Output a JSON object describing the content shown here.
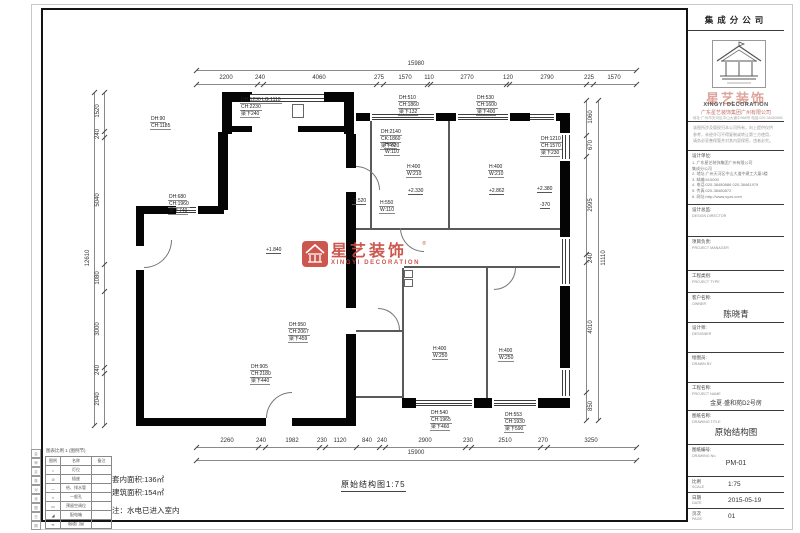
{
  "sheet": {
    "title_note": "原始结构图1:75",
    "notes": [
      "套内面积:136㎡",
      "建筑面积:154㎡",
      "注：水电已进入室内"
    ]
  },
  "watermark": {
    "cn": "星艺装饰",
    "en": "XINGYI DECORATION",
    "reg": "®"
  },
  "legend": {
    "title": "图表比例 1 (图例节)",
    "headers": [
      "图例",
      "名称",
      "备注"
    ],
    "rows": [
      [
        "•",
        "灯位",
        ""
      ],
      [
        "⊙",
        "插座",
        ""
      ],
      [
        "—",
        "给、排水管",
        ""
      ],
      [
        "≈",
        "一般孔",
        ""
      ],
      [
        "▭",
        "预留空调位",
        ""
      ],
      [
        "◢",
        "配电箱",
        ""
      ],
      [
        "▪▪",
        "烟道门窗",
        ""
      ]
    ]
  },
  "side_strip": [
    "会",
    "审",
    "定",
    "核",
    "对",
    "设",
    "图",
    "日",
    "期"
  ],
  "dims": {
    "top_total": {
      "t": "15980",
      "x": 416,
      "y": 64
    },
    "top": [
      {
        "t": "2200",
        "x": 226
      },
      {
        "t": "240",
        "x": 260
      },
      {
        "t": "4060",
        "x": 319
      },
      {
        "t": "275",
        "x": 379
      },
      {
        "t": "1570",
        "x": 405
      },
      {
        "t": "110",
        "x": 429
      },
      {
        "t": "2770",
        "x": 467
      },
      {
        "t": "120",
        "x": 508
      },
      {
        "t": "2790",
        "x": 547
      },
      {
        "t": "225",
        "x": 589
      },
      {
        "t": "1570",
        "x": 614
      }
    ],
    "bottom_total": {
      "t": "15900",
      "x": 416,
      "y": 453
    },
    "bottom": [
      {
        "t": "2260",
        "x": 227
      },
      {
        "t": "240",
        "x": 261
      },
      {
        "t": "1982",
        "x": 292
      },
      {
        "t": "230",
        "x": 322
      },
      {
        "t": "1120",
        "x": 340
      },
      {
        "t": "840",
        "x": 367
      },
      {
        "t": "240",
        "x": 382
      },
      {
        "t": "2900",
        "x": 425
      },
      {
        "t": "230",
        "x": 468
      },
      {
        "t": "2510",
        "x": 505
      },
      {
        "t": "270",
        "x": 543
      },
      {
        "t": "3250",
        "x": 591
      }
    ],
    "left_total": {
      "t": "12610",
      "x": 88,
      "y": 258
    },
    "left": [
      {
        "t": "1520",
        "y": 111
      },
      {
        "t": "240",
        "y": 134
      },
      {
        "t": "5040",
        "y": 200
      },
      {
        "t": "1080",
        "y": 278
      },
      {
        "t": "3000",
        "y": 329
      },
      {
        "t": "240",
        "y": 370
      },
      {
        "t": "2040",
        "y": 399
      }
    ],
    "right_total": {
      "t": "11110",
      "x": 604,
      "y": 258
    },
    "right": [
      {
        "t": "1060",
        "y": 117
      },
      {
        "t": "670",
        "y": 145
      },
      {
        "t": "2995",
        "y": 205
      },
      {
        "t": "240",
        "y": 258
      },
      {
        "t": "4010",
        "y": 327
      },
      {
        "t": "850",
        "y": 406
      }
    ]
  },
  "annotations": [
    {
      "x": 240,
      "y": 97,
      "lines": [
        "DH:1230 LG:1110",
        "CH:2230",
        "梁下240"
      ]
    },
    {
      "x": 150,
      "y": 116,
      "lines": [
        "DH:90",
        "CH:1185"
      ]
    },
    {
      "x": 168,
      "y": 194,
      "lines": [
        "DH:680",
        "CH:1960",
        "梁下740"
      ]
    },
    {
      "x": 380,
      "y": 129,
      "lines": [
        "DH:2140",
        "CK:1860",
        "梁下620"
      ]
    },
    {
      "x": 398,
      "y": 95,
      "lines": [
        "DH:510",
        "CH:1860",
        "梁下132"
      ]
    },
    {
      "x": 476,
      "y": 95,
      "lines": [
        "DH:530",
        "CH:1600",
        "梁下400"
      ]
    },
    {
      "x": 540,
      "y": 136,
      "lines": [
        "DH:1210",
        "CH:1570",
        "梁下230"
      ]
    },
    {
      "x": 384,
      "y": 142,
      "lines": [
        "H:90",
        "W:110"
      ]
    },
    {
      "x": 379,
      "y": 200,
      "lines": [
        "H:550",
        "W:110"
      ]
    },
    {
      "x": 406,
      "y": 164,
      "lines": [
        "H:400",
        "W:210"
      ]
    },
    {
      "x": 488,
      "y": 164,
      "lines": [
        "H:400",
        "W:210"
      ]
    },
    {
      "x": 432,
      "y": 346,
      "lines": [
        "H:400",
        "W:250"
      ]
    },
    {
      "x": 498,
      "y": 348,
      "lines": [
        "H:400",
        "W:250"
      ]
    },
    {
      "x": 430,
      "y": 410,
      "lines": [
        "DH:540",
        "CH:1965",
        "梁下460"
      ]
    },
    {
      "x": 504,
      "y": 412,
      "lines": [
        "DH:553",
        "CH:1930",
        "梁下590"
      ]
    },
    {
      "x": 288,
      "y": 322,
      "lines": [
        "DH:950",
        "CH:2067",
        "梁下459"
      ]
    },
    {
      "x": 250,
      "y": 364,
      "lines": [
        "DH:905",
        "CH:2180",
        "梁下440"
      ]
    }
  ],
  "levels": [
    {
      "x": 266,
      "y": 247,
      "t": "+1.840"
    },
    {
      "x": 352,
      "y": 198,
      "t": "-0.520"
    },
    {
      "x": 408,
      "y": 188,
      "t": "+2.330"
    },
    {
      "x": 489,
      "y": 188,
      "t": "+2.862"
    },
    {
      "x": 537,
      "y": 186,
      "t": "+2.380"
    },
    {
      "x": 540,
      "y": 202,
      "t": "-370"
    }
  ],
  "titleblock": {
    "branch": "集成分公司",
    "brand_cn": "星艺装饰",
    "brand_en": "XINGYI DECORATION",
    "company": "广东星艺装饰集团广州有限公司",
    "company_sub": "地址:广州市天河区中山大道中988号 电话:020-38480886",
    "notice_lines": [
      "该图所涉及版权归本公司所有，向上提供仅供",
      "参考，未经许可不得复制或转让第三方使用，",
      "请务必妥善保管并对其内容保密，违者必究。"
    ],
    "design_title": "设计单位:",
    "design_lines": [
      "1. 广东星艺装饰集团广州有限公司",
      "    集成分公司",
      "2. 地址:广州天河区中山大道中建工大厦3楼",
      "3. 邮编:510000",
      "4. 电话:020-38480886  020-38481979",
      "5. 传真:020-38480872",
      "6. 网址:http://www.xyzs.com"
    ],
    "sections": [
      {
        "cn": "设计总监:",
        "en": "DESIGN DIRECTOR",
        "value": ""
      },
      {
        "cn": "项目负责:",
        "en": "PROJECT MANAGER",
        "value": ""
      },
      {
        "cn": "工程类别:",
        "en": "PROJECT TYPE",
        "value": ""
      },
      {
        "cn": "客户名称:",
        "en": "OWNER",
        "value": "陈晓青"
      },
      {
        "cn": "设计师:",
        "en": "DESIGNER",
        "value": ""
      },
      {
        "cn": "绘图员:",
        "en": "DRAWN BY",
        "value": ""
      },
      {
        "cn": "工程名称:",
        "en": "PROJECT NAME",
        "value": "金夏·盛和苑D2号房"
      },
      {
        "cn": "图纸名称:",
        "en": "DRAWING TITLE",
        "value": "原始结构图"
      },
      {
        "cn": "图纸编号:",
        "en": "DRAWING No.",
        "value": "PM-01"
      }
    ],
    "footer": [
      {
        "cn": "比例",
        "en": "SCALE",
        "value": "1:75"
      },
      {
        "cn": "日期",
        "en": "DATE",
        "value": "2015-05-19"
      },
      {
        "cn": "页次",
        "en": "PAGE",
        "value": "01"
      }
    ]
  }
}
